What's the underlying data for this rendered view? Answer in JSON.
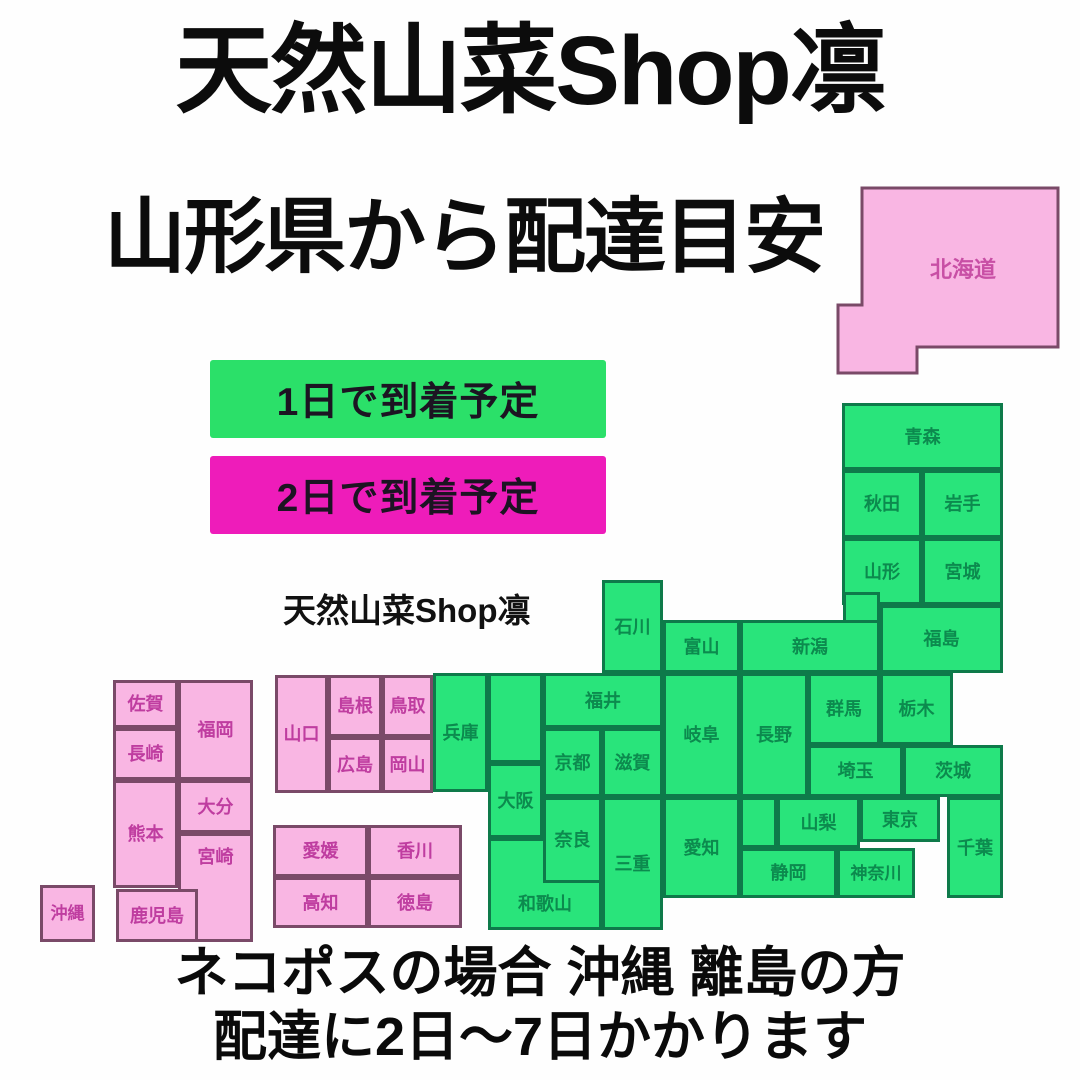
{
  "page": {
    "title": "天然山菜Shop凛",
    "subtitle": "山形県から配達目安",
    "watermark": "天然山菜Shop凛",
    "footer_line1": "ネコポスの場合 沖縄 離島の方",
    "footer_line2": "配達に2日〜7日かかります"
  },
  "legend": {
    "one_day": {
      "label": "1日で到着予定",
      "color": "#2be069"
    },
    "two_day": {
      "label": "2日で到着予定",
      "color": "#ee1cba"
    }
  },
  "colors": {
    "green_fill": "#29e47b",
    "green_border": "#0e7a4a",
    "green_text": "#0c8a4e",
    "pink_fill": "#f9b6e3",
    "pink_border": "#7a4a68",
    "pink_text": "#bf3da0",
    "heading_text": "#0c0c0c"
  },
  "map": {
    "origin_prefecture": "山形",
    "prefectures": {
      "hokkaido": {
        "label": "北海道",
        "delivery": "2日"
      },
      "aomori": {
        "label": "青森",
        "delivery": "1日"
      },
      "akita": {
        "label": "秋田",
        "delivery": "1日"
      },
      "iwate": {
        "label": "岩手",
        "delivery": "1日"
      },
      "yamagata": {
        "label": "山形",
        "delivery": "1日"
      },
      "miyagi": {
        "label": "宮城",
        "delivery": "1日"
      },
      "fukushima": {
        "label": "福島",
        "delivery": "1日"
      },
      "niigata": {
        "label": "新潟",
        "delivery": "1日"
      },
      "ishikawa": {
        "label": "石川",
        "delivery": "1日"
      },
      "toyama": {
        "label": "富山",
        "delivery": "1日"
      },
      "fukui": {
        "label": "福井",
        "delivery": "1日"
      },
      "gifu": {
        "label": "岐阜",
        "delivery": "1日"
      },
      "nagano": {
        "label": "長野",
        "delivery": "1日"
      },
      "gunma": {
        "label": "群馬",
        "delivery": "1日"
      },
      "tochigi": {
        "label": "栃木",
        "delivery": "1日"
      },
      "saitama": {
        "label": "埼玉",
        "delivery": "1日"
      },
      "ibaraki": {
        "label": "茨城",
        "delivery": "1日"
      },
      "yamanashi": {
        "label": "山梨",
        "delivery": "1日"
      },
      "tokyo": {
        "label": "東京",
        "delivery": "1日"
      },
      "chiba": {
        "label": "千葉",
        "delivery": "1日"
      },
      "shizuoka": {
        "label": "静岡",
        "delivery": "1日"
      },
      "kanagawa": {
        "label": "神奈川",
        "delivery": "1日"
      },
      "hyogo": {
        "label": "兵庫",
        "delivery": "1日"
      },
      "kyoto": {
        "label": "京都",
        "delivery": "1日"
      },
      "shiga": {
        "label": "滋賀",
        "delivery": "1日"
      },
      "osaka": {
        "label": "大阪",
        "delivery": "1日"
      },
      "nara": {
        "label": "奈良",
        "delivery": "1日"
      },
      "mie": {
        "label": "三重",
        "delivery": "1日"
      },
      "aichi": {
        "label": "愛知",
        "delivery": "1日"
      },
      "wakayama": {
        "label": "和歌山",
        "delivery": "1日"
      },
      "yamaguchi": {
        "label": "山口",
        "delivery": "2日"
      },
      "shimane": {
        "label": "島根",
        "delivery": "2日"
      },
      "tottori": {
        "label": "鳥取",
        "delivery": "2日"
      },
      "hiroshima": {
        "label": "広島",
        "delivery": "2日"
      },
      "okayama": {
        "label": "岡山",
        "delivery": "2日"
      },
      "saga": {
        "label": "佐賀",
        "delivery": "2日"
      },
      "fukuoka": {
        "label": "福岡",
        "delivery": "2日"
      },
      "nagasaki": {
        "label": "長崎",
        "delivery": "2日"
      },
      "kumamoto": {
        "label": "熊本",
        "delivery": "2日"
      },
      "oita": {
        "label": "大分",
        "delivery": "2日"
      },
      "miyazaki": {
        "label": "宮崎",
        "delivery": "2日"
      },
      "kagoshima": {
        "label": "鹿児島",
        "delivery": "2日"
      },
      "ehime": {
        "label": "愛媛",
        "delivery": "2日"
      },
      "kagawa": {
        "label": "香川",
        "delivery": "2日"
      },
      "kochi": {
        "label": "高知",
        "delivery": "2日"
      },
      "tokushima": {
        "label": "徳島",
        "delivery": "2日"
      },
      "okinawa": {
        "label": "沖縄",
        "delivery": "2日"
      }
    }
  }
}
